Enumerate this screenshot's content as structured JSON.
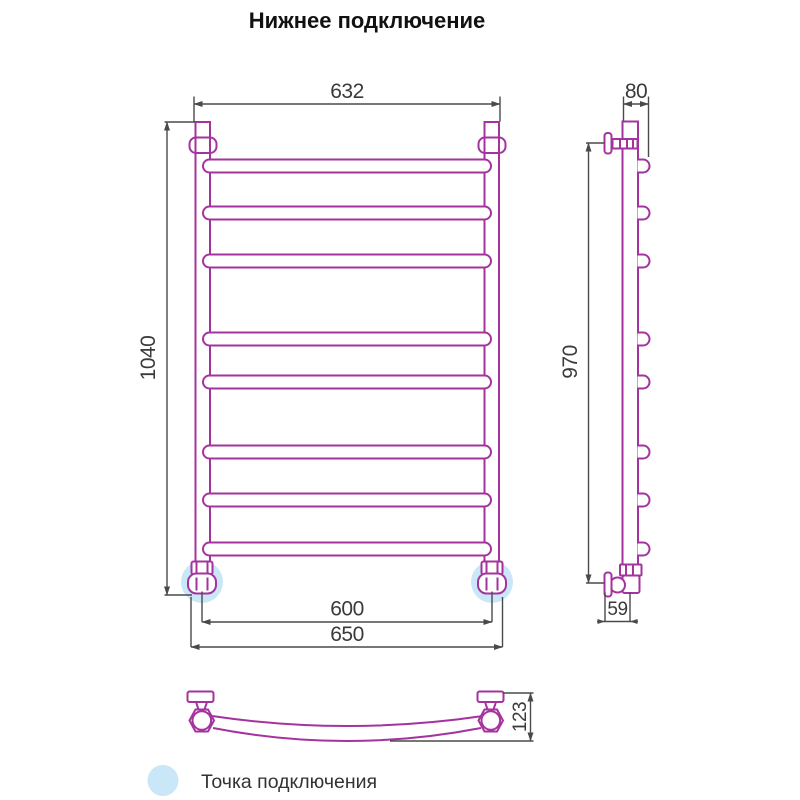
{
  "title": "Нижнее подключение",
  "front_view": {
    "width_top": "632",
    "height": "1040",
    "connection_spacing": "600",
    "overall_width": "650"
  },
  "side_view": {
    "depth_top": "80",
    "height": "970",
    "depth_bottom": "59"
  },
  "top_view": {
    "bow_depth": "123"
  },
  "legend": {
    "connection_point_label": "Точка подключения"
  },
  "colors": {
    "rail": "#a5339e",
    "dimension_line": "#4a4a4a",
    "text": "#3a3a3a",
    "connection_point": "#c9e7f6"
  }
}
